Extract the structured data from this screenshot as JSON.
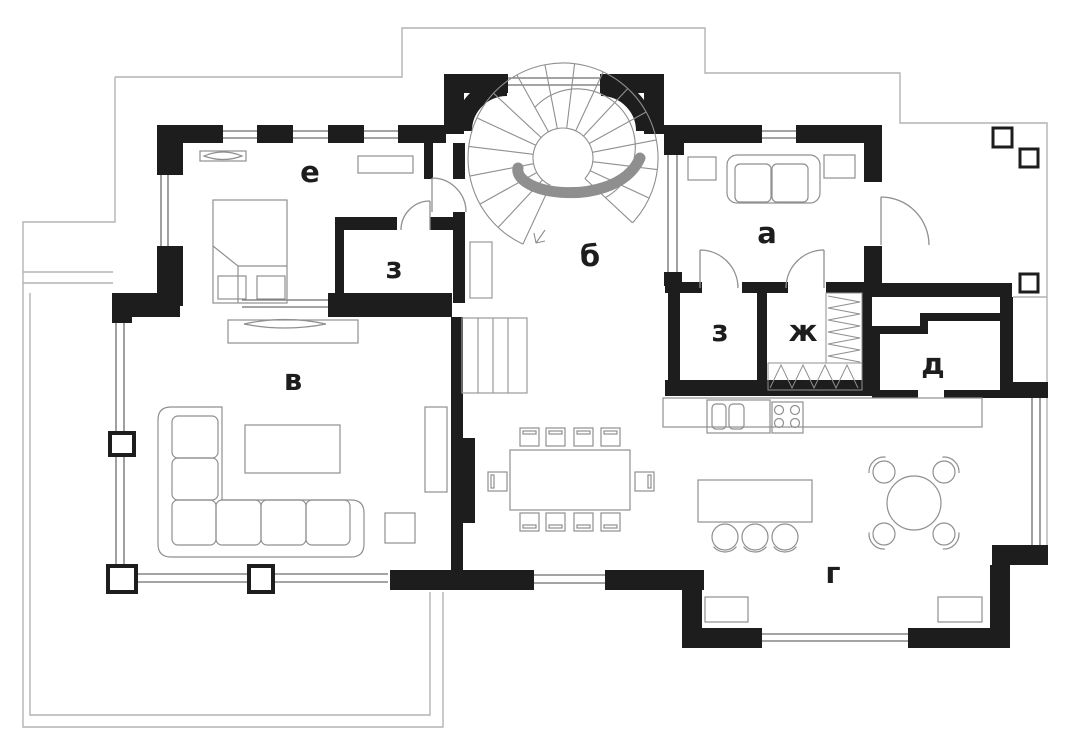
{
  "plan": {
    "type": "architectural-floor-plan",
    "floor": "first-floor",
    "rooms": [
      {
        "id": "a",
        "label": "а"
      },
      {
        "id": "b",
        "label": "б"
      },
      {
        "id": "v",
        "label": "в"
      },
      {
        "id": "g",
        "label": "г"
      },
      {
        "id": "d",
        "label": "д"
      },
      {
        "id": "e",
        "label": "е"
      },
      {
        "id": "zh",
        "label": "ж"
      },
      {
        "id": "z1",
        "label": "з"
      },
      {
        "id": "z2",
        "label": "з"
      }
    ],
    "colors": {
      "wall": "#1d1d1d",
      "thin_outline": "#b3b3b3",
      "window": "#6e6e6e",
      "furniture": "#8f8f8f",
      "label": "#1d1d1d",
      "background": "#ffffff"
    }
  }
}
